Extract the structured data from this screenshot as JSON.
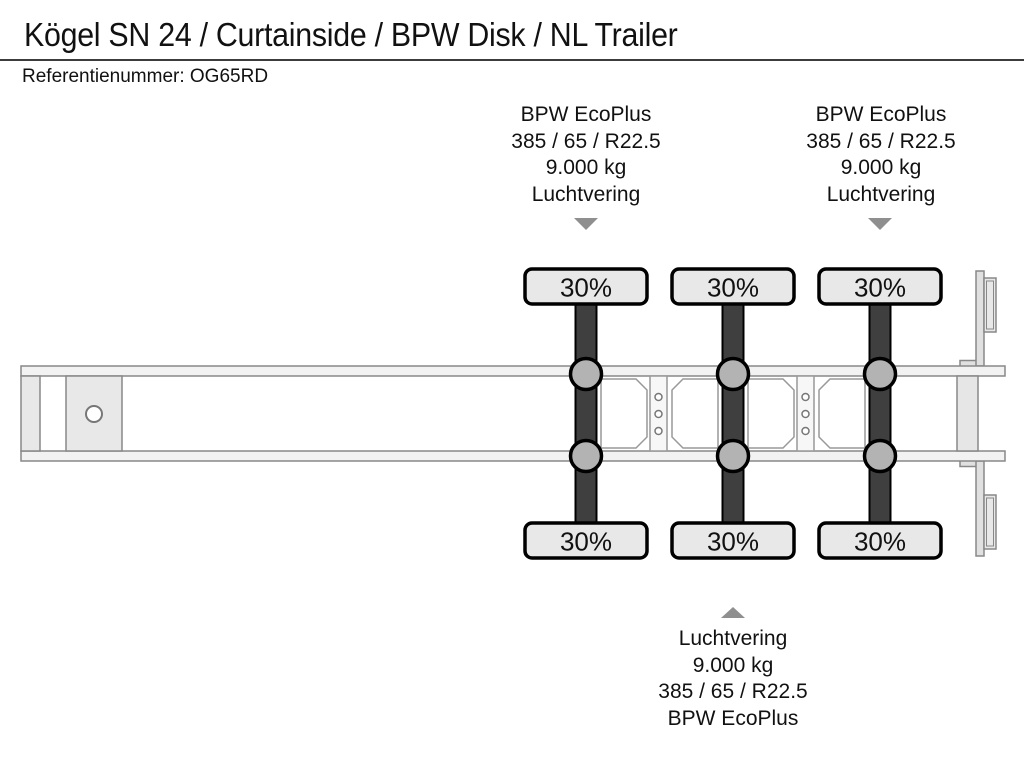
{
  "header": {
    "title": "Kögel SN 24 / Curtainside / BPW Disk / NL Trailer",
    "reference": "Referentienummer: OG65RD"
  },
  "annotations": {
    "axle1": {
      "position": "top-left",
      "arrow": "down",
      "lines": [
        "BPW EcoPlus",
        "385 / 65 / R22.5",
        "9.000 kg",
        "Luchtvering"
      ]
    },
    "axle3": {
      "position": "top-right",
      "arrow": "down",
      "lines": [
        "BPW EcoPlus",
        "385 / 65 / R22.5",
        "9.000 kg",
        "Luchtvering"
      ]
    },
    "axle2": {
      "position": "bottom",
      "arrow": "up",
      "lines": [
        "Luchtvering",
        "9.000 kg",
        "385 / 65 / R22.5",
        "BPW EcoPlus"
      ]
    }
  },
  "diagram": {
    "description": "Top view schematic of 3-axle trailer chassis with tire wear percentages",
    "tires": [
      {
        "axle": 1,
        "side": "top",
        "label": "30%"
      },
      {
        "axle": 2,
        "side": "top",
        "label": "30%"
      },
      {
        "axle": 3,
        "side": "top",
        "label": "30%"
      },
      {
        "axle": 1,
        "side": "bottom",
        "label": "30%"
      },
      {
        "axle": 2,
        "side": "bottom",
        "label": "30%"
      },
      {
        "axle": 3,
        "side": "bottom",
        "label": "30%"
      }
    ]
  },
  "colors": {
    "axle_bar": "#3f3f3f",
    "tire_fill": "#e8e8e8",
    "suspension_circle_fill": "#b3b3b3",
    "chassis_fill": "#f2f2f2",
    "chassis_stroke": "#888888",
    "panel_stroke": "#999999",
    "arrow_gray": "#8f8f8f",
    "text": "#111111",
    "background": "#ffffff"
  }
}
